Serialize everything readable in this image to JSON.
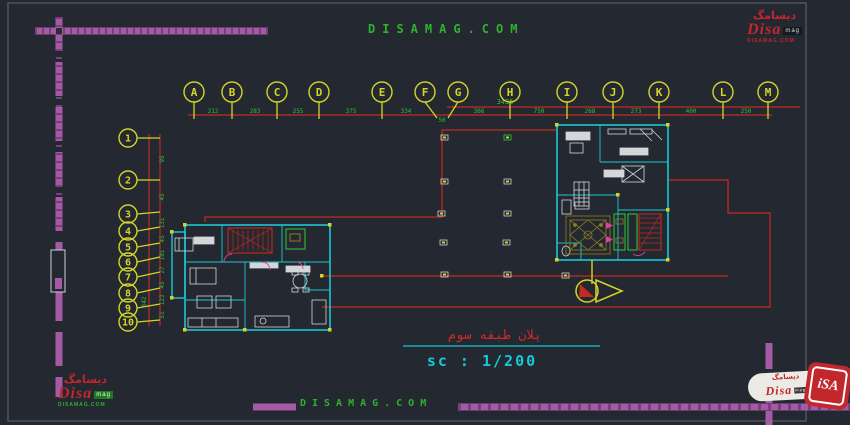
{
  "watermark": {
    "top": "DISAMAG.COM",
    "bottom": "DISAMAG.COM"
  },
  "title_block": {
    "title_fa": "پلان طبقه سوم",
    "scale": "sc : 1/200"
  },
  "grid": {
    "total_width": "3435",
    "left_total": "342",
    "columns": [
      "A",
      "B",
      "C",
      "D",
      "E",
      "F",
      "G",
      "H",
      "I",
      "J",
      "K",
      "L",
      "M"
    ],
    "col_dims": [
      "212",
      "283",
      "255",
      "375",
      "334",
      "50",
      "366",
      "750",
      "268",
      "273",
      "400",
      "250"
    ],
    "rows": [
      "1",
      "2",
      "3",
      "4",
      "5",
      "6",
      "7",
      "8",
      "9",
      "10"
    ],
    "row_dims": [
      "95",
      "45",
      "131",
      "45",
      "101",
      "27",
      "45",
      "123",
      "51"
    ]
  },
  "logos": {
    "top_right": {
      "farsi": "دیسامگ",
      "name": "Disa",
      "suffix": "mag",
      "site": "DISAMAG.COM"
    },
    "bottom_left": {
      "farsi": "دیسامگ",
      "name": "Disa",
      "suffix": "mag",
      "site_a": "DISAMAG.",
      "site_b": "COM"
    },
    "bottom_right": {
      "farsi": "دیسامگ",
      "name": "Disa",
      "suffix": "mag",
      "icon_text": "iSA"
    }
  },
  "colors": {
    "background": "#242830",
    "frame": "#4e545c",
    "purple": "#a55aa5",
    "red": "#c22a22",
    "yellow": "#d4d42a",
    "green_text": "#2fbf3f",
    "cyan": "#1ac8d4",
    "white_lines": "#d4d7da",
    "olive": "#8f7d22",
    "magenta": "#e23fa0",
    "scale_cyan": "#17c8d8",
    "logo_red": "#c1272d",
    "watermark_green": "#2db32d"
  }
}
